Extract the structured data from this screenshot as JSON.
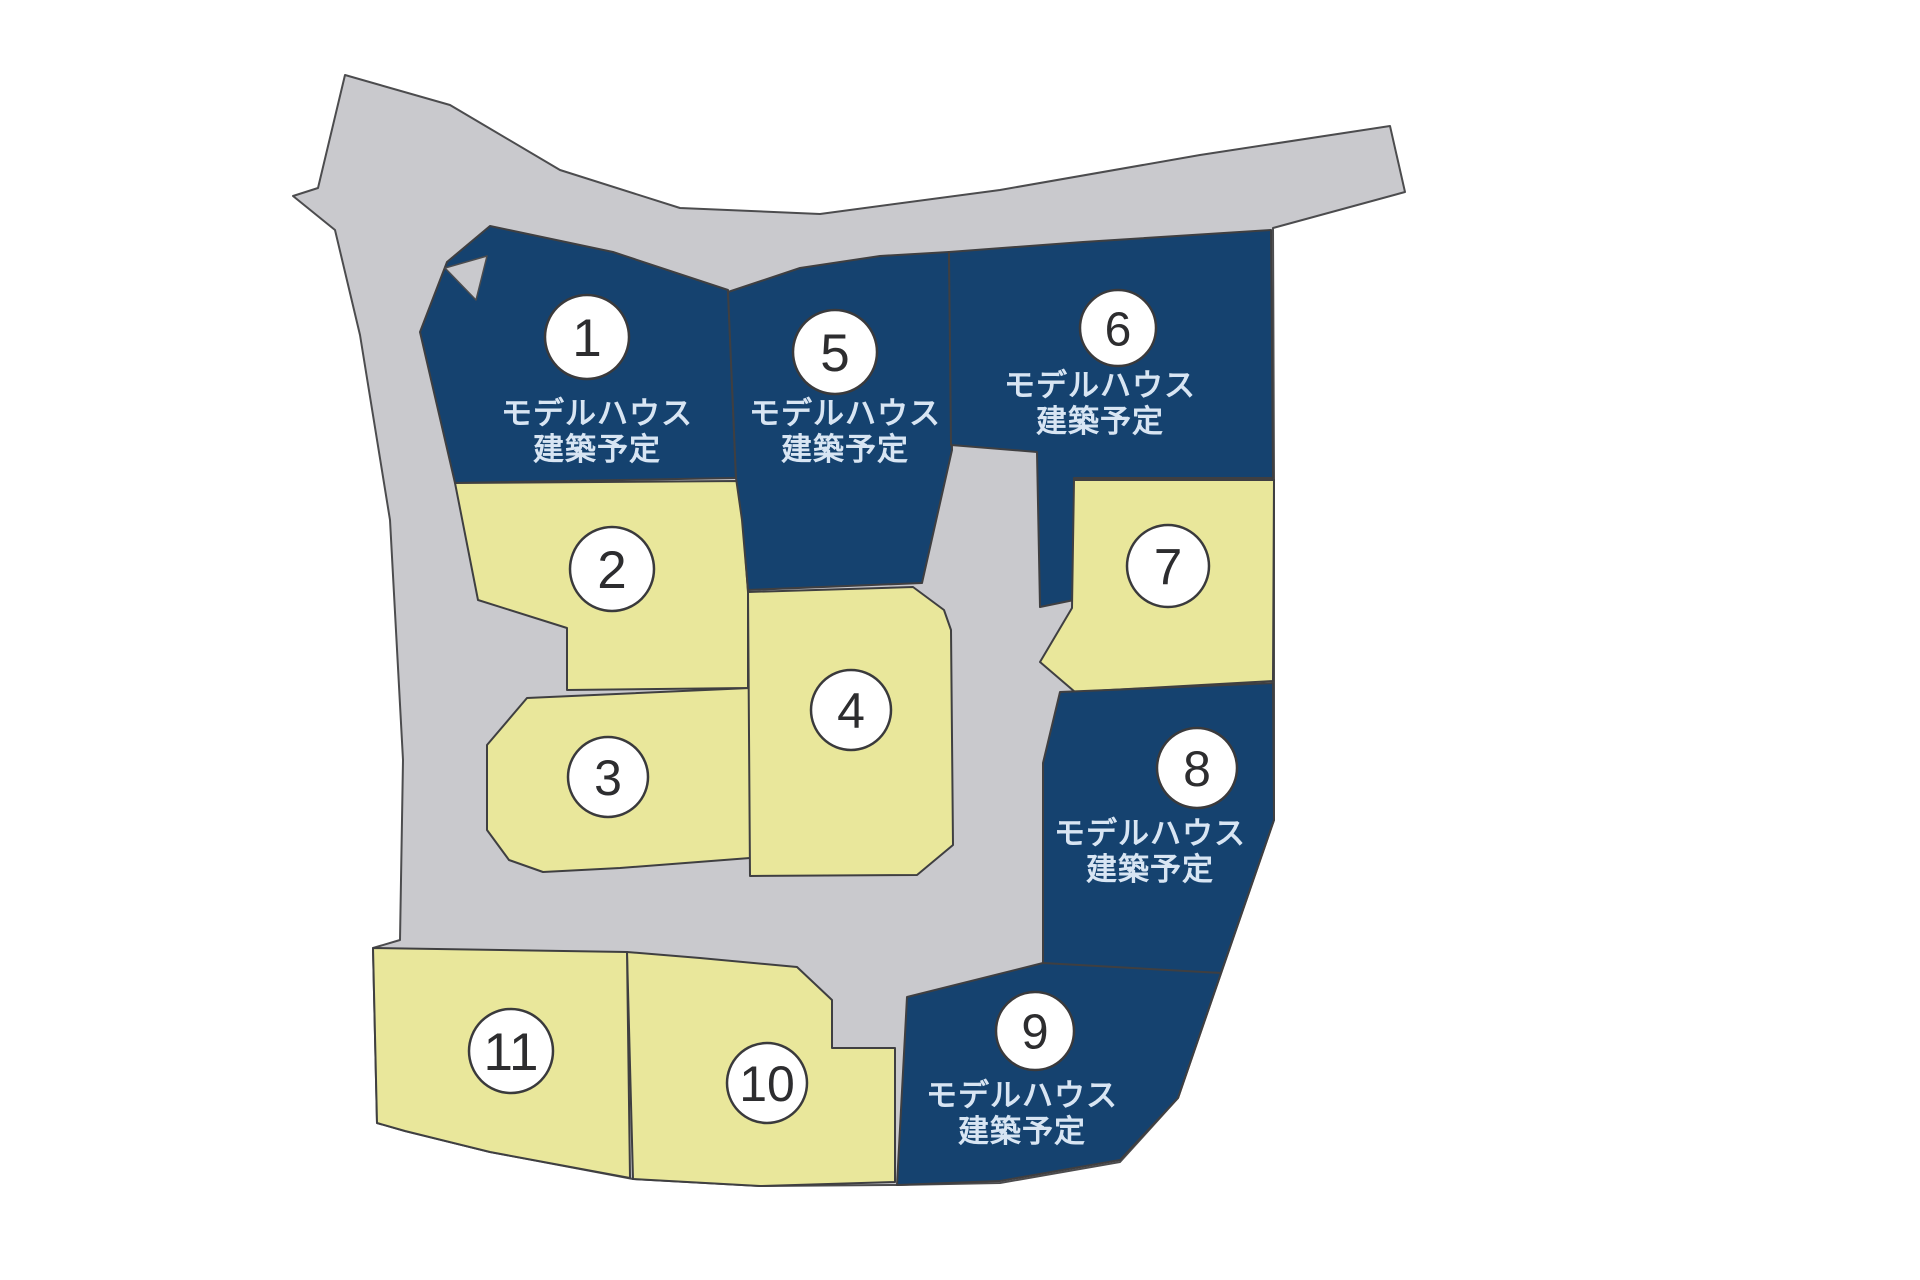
{
  "map": {
    "title": "分譲地 区画図",
    "colors": {
      "background": "#ffffff",
      "road": "#c9c9cd",
      "lot_reserved": "#15426f",
      "lot_available": "#e9e79b",
      "outline": "#4c4c4e",
      "circle_fill": "#ffffff",
      "circle_stroke": "#3a3a3c",
      "number_text": "#2d2d2f",
      "label_text": "#d8e5f3"
    },
    "reserved_label_line1": "モデルハウス",
    "reserved_label_line2": "建築予定",
    "hull_points": "345,75 450,105 560,170 680,208 820,214 1000,190 1200,155 1390,126 1405,192 1273,228 1274,478 1274,820 1178,1098 1120,1162 1000,1183 897,1185 760,1186 633,1179 490,1152 405,1131 377,1123 373,948 400,940 403,760 390,520 360,335 335,230 293,196 318,188",
    "road_patches": [
      {
        "name": "lot-1-corner-notch",
        "points": "445,268 487,256 476,300"
      }
    ],
    "lots": [
      {
        "number": "1",
        "type": "reserved",
        "points": "490,226 613,252 728,290 736,478 455,483 420,332 447,262",
        "circle": {
          "x": 587,
          "y": 337,
          "r": 42
        },
        "label": {
          "x": 597,
          "y": 424,
          "line_height": 36
        }
      },
      {
        "number": "2",
        "type": "available",
        "points": "455,483 740,481 748,592 748,688 567,690 567,628 478,600",
        "circle": {
          "x": 612,
          "y": 569,
          "r": 42
        },
        "label": null
      },
      {
        "number": "3",
        "type": "available",
        "points": "527,698 750,688 750,858 620,868 543,872 509,860 487,830 487,745",
        "circle": {
          "x": 608,
          "y": 777,
          "r": 40
        },
        "label": null
      },
      {
        "number": "4",
        "type": "available",
        "points": "748,592 913,587 944,610 951,630 953,845 917,875 750,876",
        "circle": {
          "x": 851,
          "y": 710,
          "r": 40
        },
        "label": null
      },
      {
        "number": "5",
        "type": "reserved",
        "points": "728,292 800,268 880,256 949,252 952,450 922,583 748,590 742,520 736,478",
        "circle": {
          "x": 835,
          "y": 352,
          "r": 42
        },
        "label": {
          "x": 845,
          "y": 424,
          "line_height": 36
        }
      },
      {
        "number": "6",
        "type": "reserved",
        "points": "949,252 1083,242 1271,230 1273,478 1074,478 1074,600 1040,607 1037,452 951,445",
        "circle": {
          "x": 1118,
          "y": 328,
          "r": 38
        },
        "label": {
          "x": 1100,
          "y": 396,
          "line_height": 36
        }
      },
      {
        "number": "7",
        "type": "available",
        "points": "1074,480 1274,480 1273,681 1075,692 1040,662 1072,608",
        "circle": {
          "x": 1168,
          "y": 566,
          "r": 41
        },
        "label": null
      },
      {
        "number": "8",
        "type": "reserved",
        "points": "1060,692 1273,683 1274,820 1221,973 1043,965 1043,763",
        "circle": {
          "x": 1197,
          "y": 768,
          "r": 40
        },
        "label": {
          "x": 1150,
          "y": 844,
          "line_height": 36
        }
      },
      {
        "number": "9",
        "type": "reserved",
        "points": "907,997 1043,963 1221,973 1178,1098 1120,1160 1000,1181 897,1185",
        "circle": {
          "x": 1035,
          "y": 1031,
          "r": 39
        },
        "label": {
          "x": 1022,
          "y": 1106,
          "line_height": 36
        }
      },
      {
        "number": "10",
        "type": "available",
        "points": "627,952 700,958 797,967 832,1000 832,1048 895,1048 895,1182 760,1186 633,1179",
        "circle": {
          "x": 767,
          "y": 1083,
          "r": 40
        },
        "label": null
      },
      {
        "number": "11",
        "type": "available",
        "points": "373,948 627,952 630,1178 490,1152 405,1131 377,1123",
        "circle": {
          "x": 511,
          "y": 1051,
          "r": 42
        },
        "label": null
      }
    ]
  }
}
